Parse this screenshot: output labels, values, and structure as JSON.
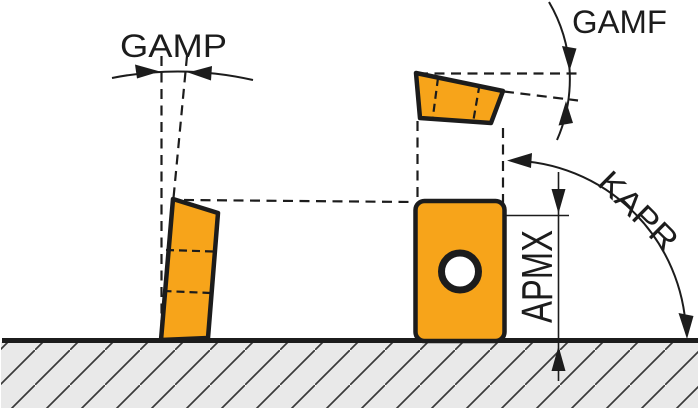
{
  "diagram": {
    "title_hint": "cutting insert geometry diagram",
    "labels": {
      "gamp": "GAMP",
      "gamf": "GAMF",
      "kapr": "KAPR",
      "apmx": "APMX"
    },
    "colors": {
      "insert-fill": "#F7A41A",
      "line": "#1C1C1C",
      "ground-fill": "#E9E9E9",
      "hatch-line": "#3A3A3A",
      "background": "#FFFFFF"
    }
  }
}
